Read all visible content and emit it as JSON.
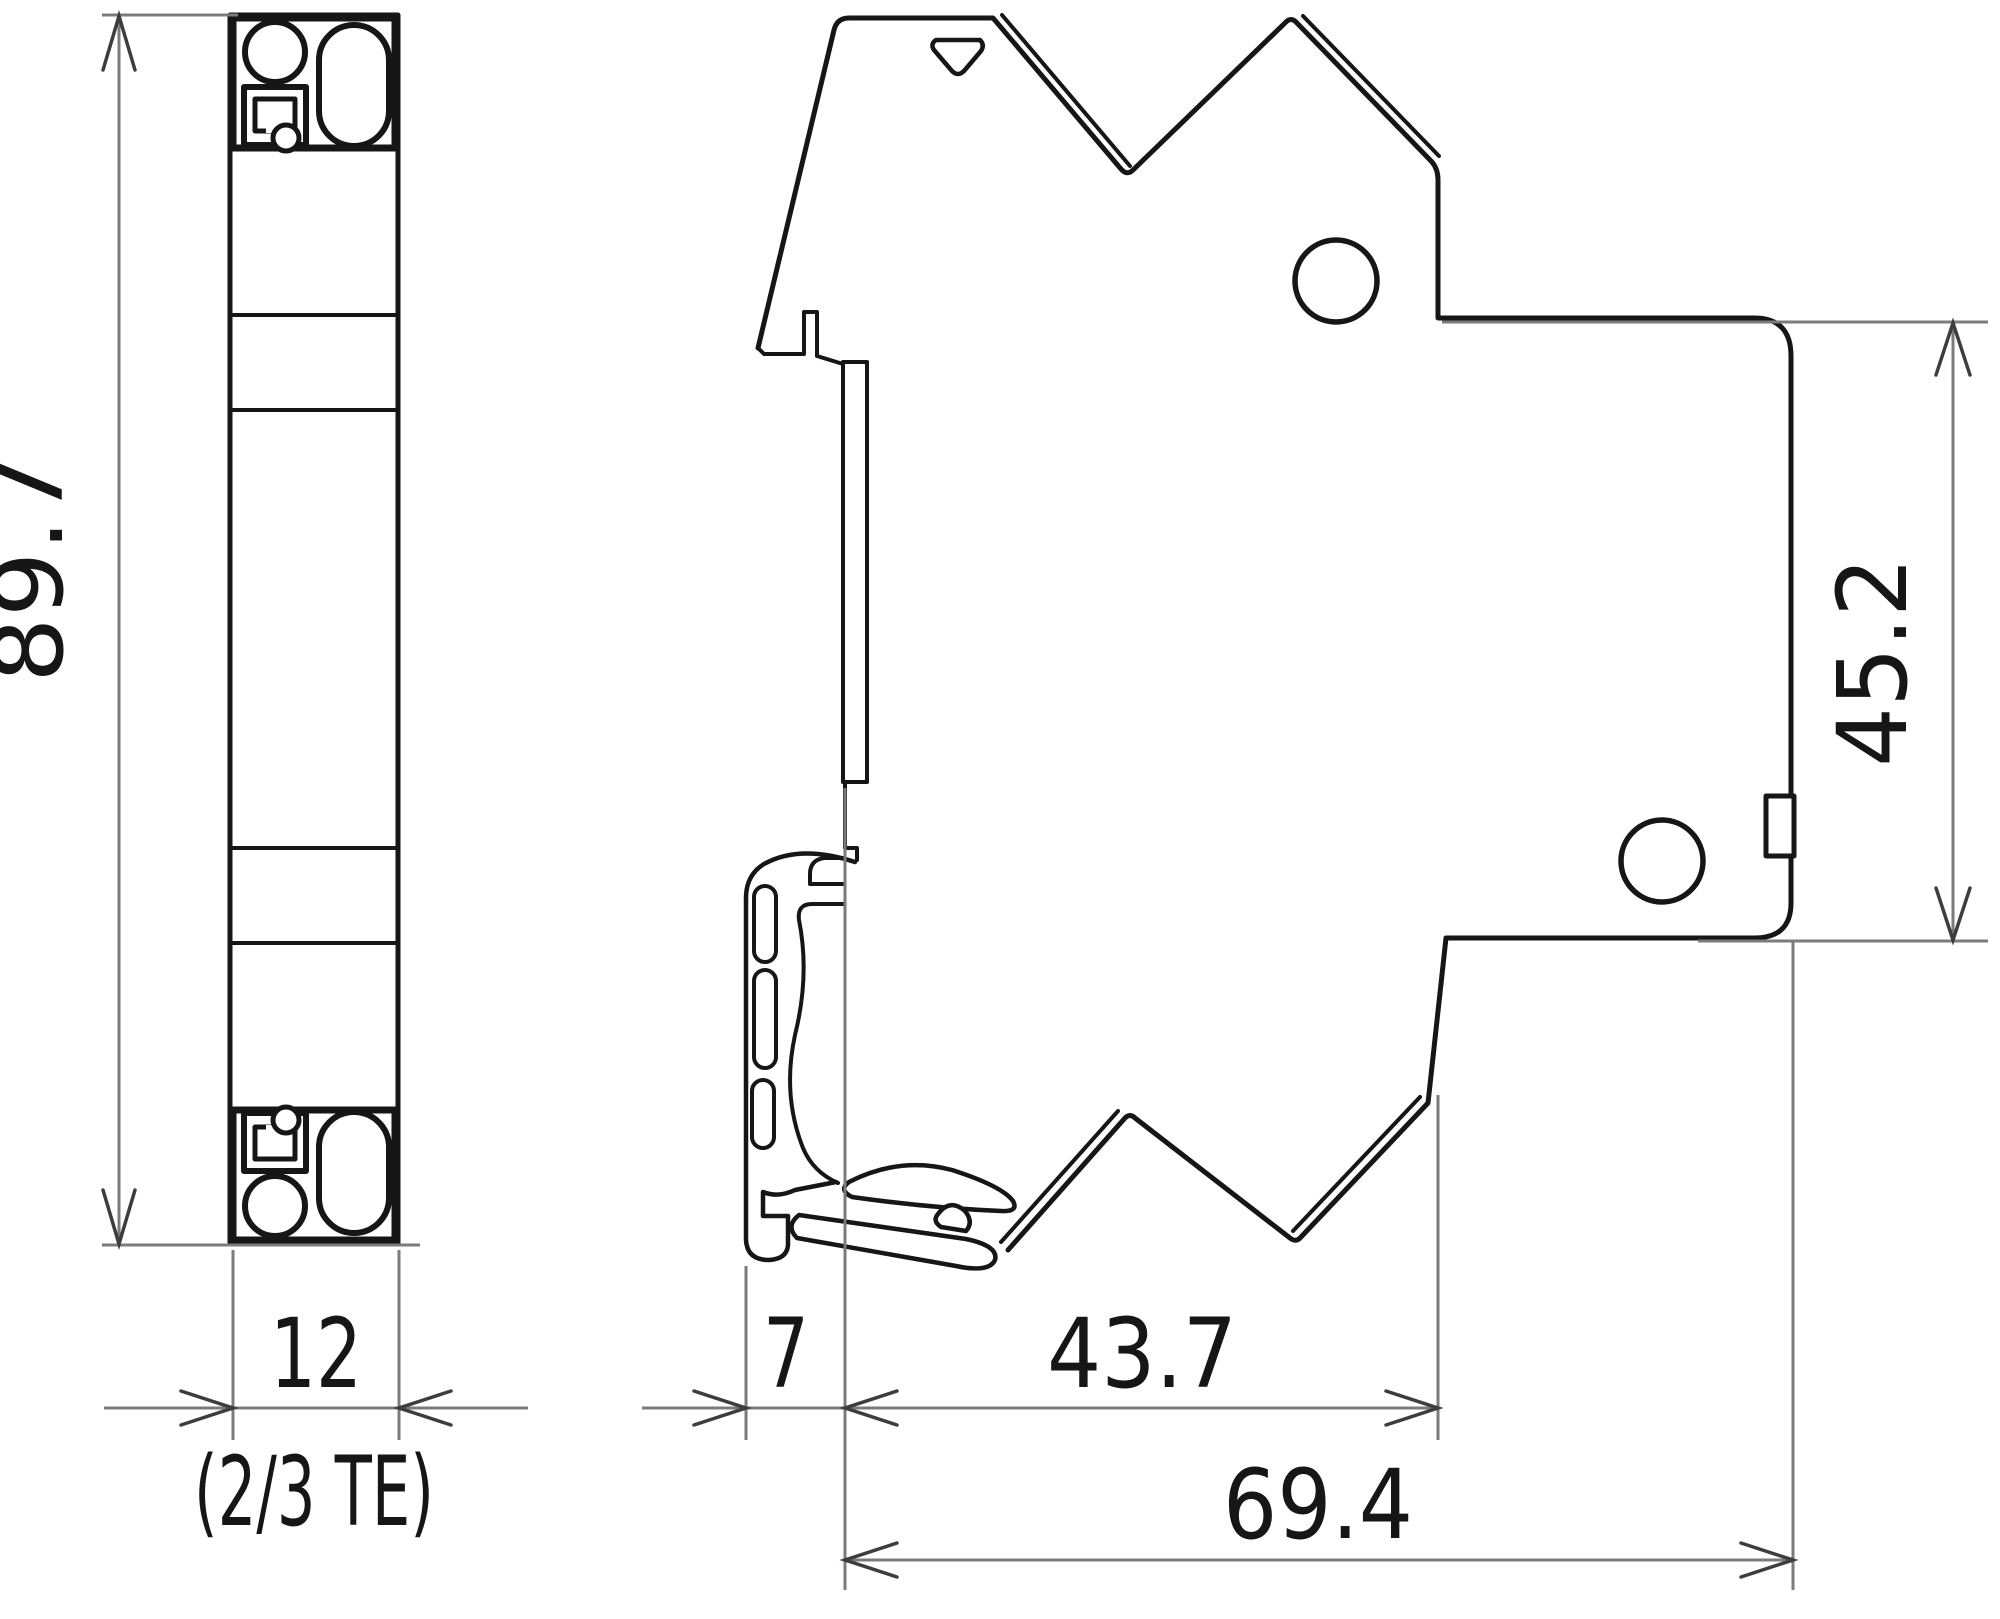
{
  "drawing": {
    "description": "Dimensional drawing of a 12 mm (2/3 TE) DIN rail device, front view and side view",
    "dimensions": {
      "overall_height": "89.7",
      "module_width": "12",
      "module_width_note": "(2/3 TE)",
      "rail_offset": "7",
      "front_depth": "43.7",
      "total_depth": "69.4",
      "rear_depth": "45.2"
    },
    "colors": {
      "outline": "#161616",
      "dimension_line": "#7b7b7b",
      "arrow": "#3d3d3d",
      "background": "#ffffff"
    }
  }
}
